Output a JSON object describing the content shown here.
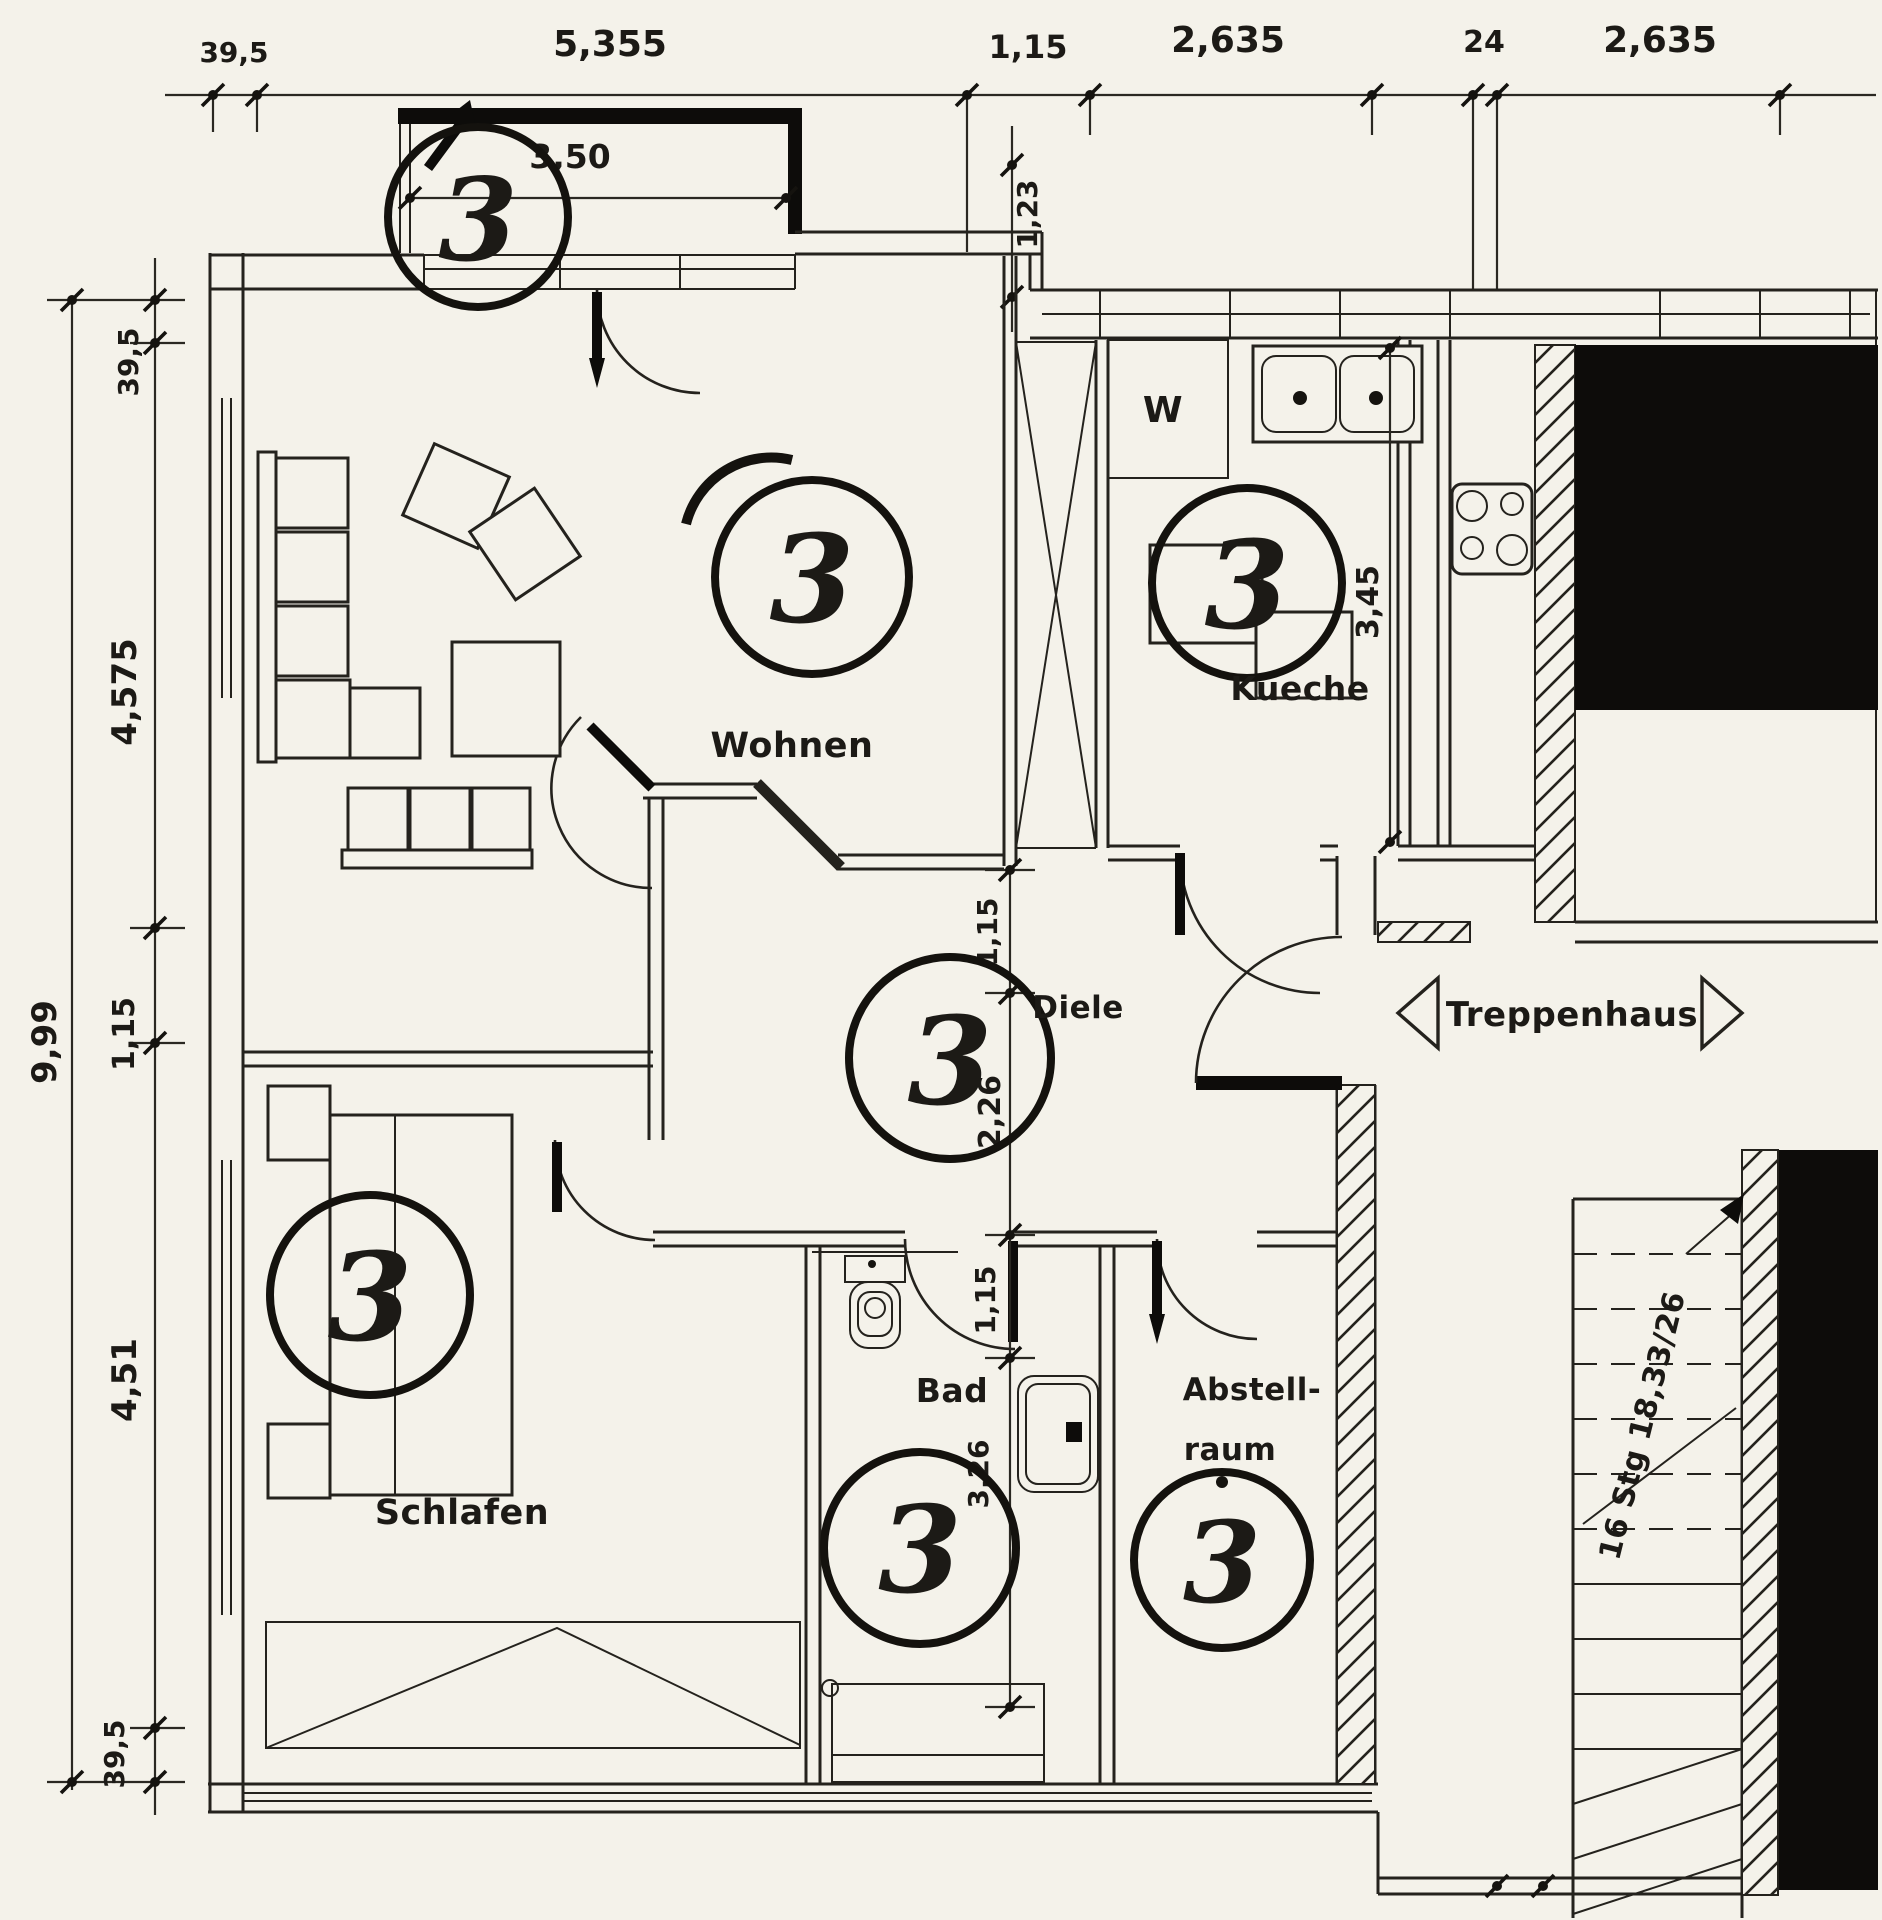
{
  "colors": {
    "paper": "#f4f2ea",
    "ink": "#24221d",
    "black": "#0d0c0a"
  },
  "plan": {
    "unit_label": "3",
    "rooms": {
      "wohnen": "Wohnen",
      "kueche": "Kueche",
      "washer": "W",
      "diele": "Diele",
      "treppenhaus": "Treppenhaus",
      "schlafen": "Schlafen",
      "bad": "Bad",
      "abstell_line1": "Abstell-",
      "abstell_line2": "raum"
    },
    "stairs_note": "16 Stg 18,33/26",
    "dims": {
      "top": [
        "39,5",
        "5,355",
        "1,15",
        "2,635",
        "24",
        "2,635"
      ],
      "left": [
        "39,5",
        "4,575",
        "1,15",
        "4,51",
        "39,5"
      ],
      "left_total": "9,99",
      "balcony_width": "3,50",
      "balcony_depth": "1,23",
      "kueche_depth": "3,45",
      "diele_chain": [
        "1,15",
        "2,26",
        "1,15"
      ],
      "bad_depth": "3,26"
    }
  }
}
